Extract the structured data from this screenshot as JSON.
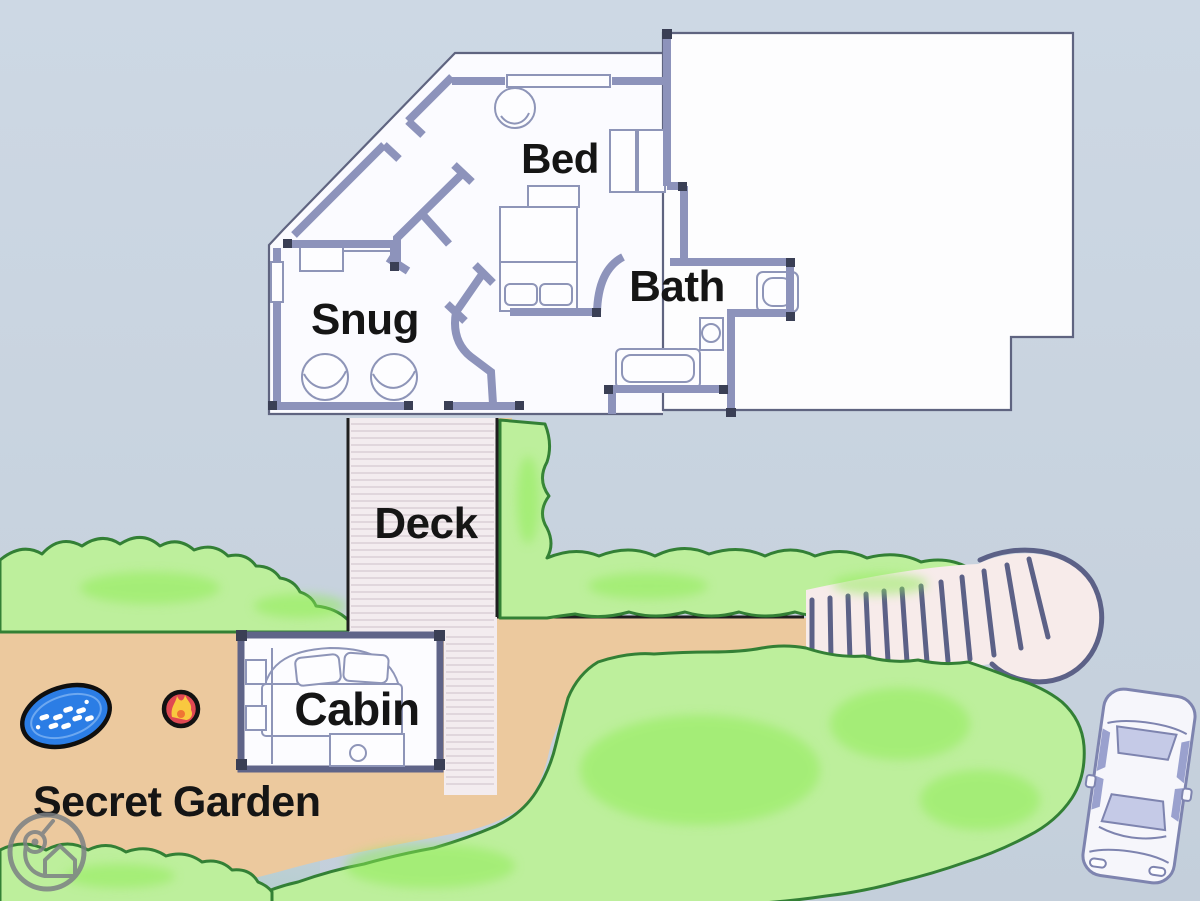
{
  "illustration": {
    "type": "hand-drawn holiday property site plan, top-down view",
    "labels": {
      "bed": "Bed",
      "snug": "Snug",
      "bath": "Bath",
      "deck": "Deck",
      "cabin": "Cabin",
      "secret_garden": "Secret Garden"
    },
    "features": [
      "main-house-floorplan",
      "unlabelled-house-wing",
      "deck-walkway",
      "garden-cabin",
      "hot-tub",
      "fire-pit",
      "garden-steps-path",
      "hedges-and-lawn",
      "parked-car",
      "brand-watermark"
    ],
    "colors": {
      "background": "#cbd6e2",
      "ground": "#ecc99e",
      "grass_fill": "#bdef9c",
      "grass_accent": "#8dec52",
      "grass_outline": "#338035",
      "plan_fill": "#fbfbff",
      "wall": "#8d93bb",
      "wall_dark": "#3a3f55",
      "deck_fill": "#f3ecef",
      "deck_plank": "#dacfd5",
      "steps_fill": "#f7ebea",
      "steps_tread": "#5c6187",
      "hot_tub_blue": "#2b7de5",
      "fire_red": "#e04852",
      "fire_yellow": "#f9c83f",
      "car_window": "#c5cae7",
      "label_color": "#151515"
    }
  }
}
